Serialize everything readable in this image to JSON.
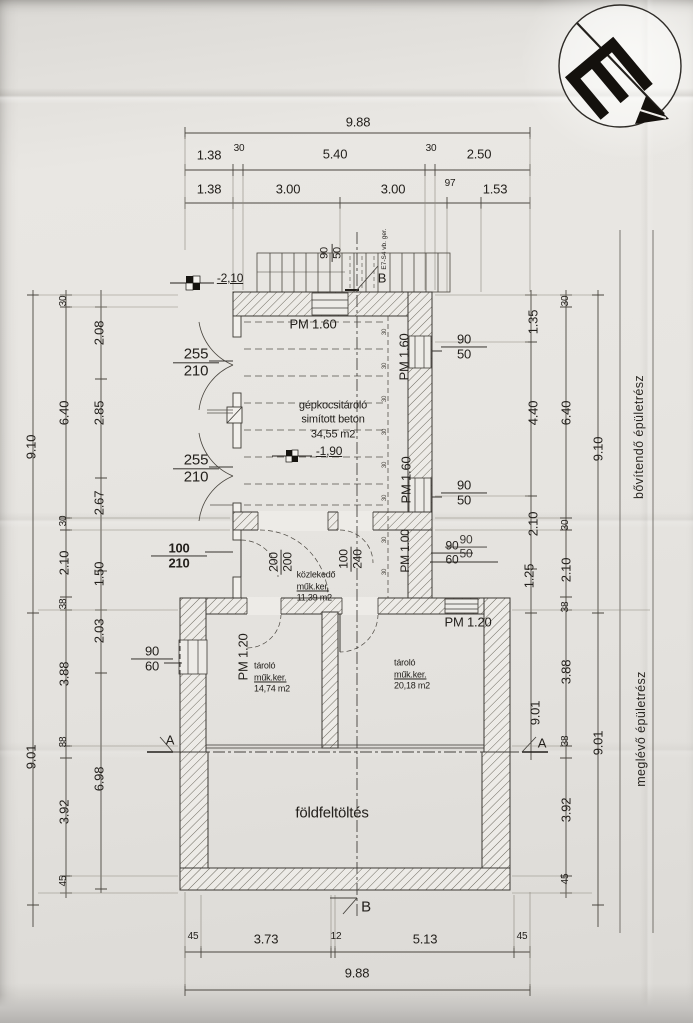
{
  "dims_top": {
    "total": "9.88",
    "row2": [
      "1.38",
      "30",
      "5.40",
      "30",
      "2.50"
    ],
    "row3": [
      "1.38",
      "3.00",
      "3.00",
      "97",
      "1.53"
    ]
  },
  "dims_bottom": {
    "row": [
      "45",
      "3.73",
      "12",
      "5.13",
      "45"
    ],
    "total": "9.88"
  },
  "dims_left": {
    "overall_upper": "9.10",
    "overall_lower": "9.01",
    "chain_outer": [
      "30",
      "6.40",
      "30",
      "2.10",
      "38",
      "3.88",
      "38",
      "3.92",
      "45"
    ],
    "chain_inner": [
      "2.08",
      "2.85",
      "2.67",
      "1.50",
      "2.03",
      "6.98"
    ]
  },
  "dims_right": {
    "chain_inner": [
      "1.35",
      "4.40",
      "2.10",
      "1.25",
      "9.01"
    ],
    "chain_mid": [
      "30",
      "6.40",
      "30",
      "2.10",
      "38",
      "3.88",
      "38",
      "3.92",
      "45"
    ],
    "overall_upper": "9.10",
    "overall_lower": "9.01"
  },
  "rooms": {
    "garage": {
      "name": "gépkocsitároló",
      "floor": "simított beton",
      "area": "34,55 m2"
    },
    "corridor": {
      "name": "közlekedő",
      "floor": "műk.ker.",
      "area": "11,39 m2"
    },
    "storage1": {
      "name": "tároló",
      "floor": "műk.ker.",
      "area": "14,74 m2"
    },
    "storage2": {
      "name": "tároló",
      "floor": "műk.ker.",
      "area": "20,18 m2"
    },
    "fill": "földfeltöltés"
  },
  "parapets": {
    "pm160": "PM 1.60",
    "pm120": "PM 1.20",
    "pm100": "PM 1.00"
  },
  "levels": {
    "l210": "-2,10",
    "l190": "-1,90"
  },
  "openings": {
    "d255w": "255",
    "d255h": "210",
    "w90": "90",
    "w50": "50",
    "w60": "60",
    "d100w": "100",
    "d100h": "210",
    "d200w": "200",
    "d200h": "200",
    "d100bw": "100",
    "d100bh": "240"
  },
  "annotations": {
    "part_new": "bővítendő épületrész",
    "part_existing": "meglévő épületrész",
    "beam_note": "E7-S4 vb. ger.",
    "sa": "A",
    "sb": "B",
    "slope": "30"
  }
}
